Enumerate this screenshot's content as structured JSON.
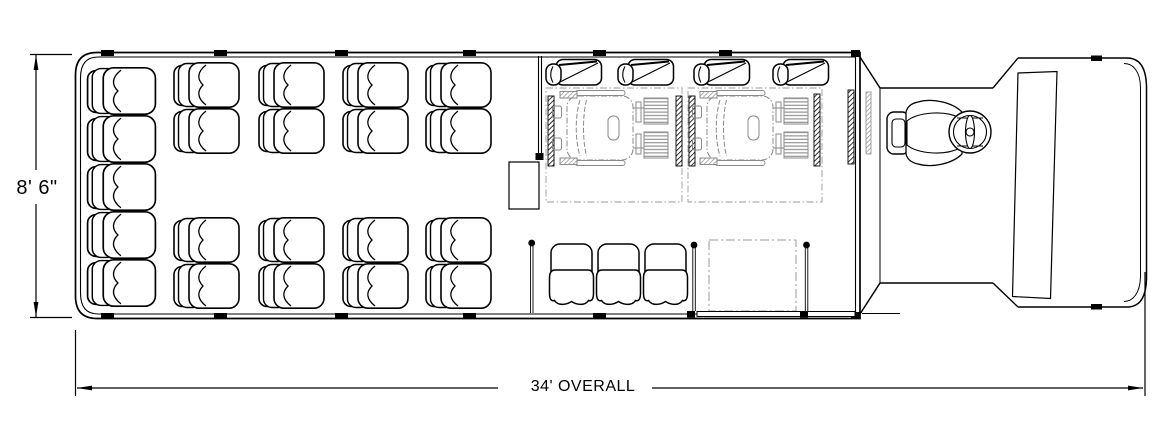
{
  "page": {
    "background": "#ffffff",
    "line_color": "#000000",
    "detail_color": "#878787"
  },
  "dimensions": {
    "height_label": "8' 6\"",
    "length_label": "34' OVERALL"
  },
  "floorplan": {
    "view": "top",
    "rear_bench_seats": 5,
    "forward_double_seat_units": 8,
    "forward_seats_total": 16,
    "flip_up_seats": 4,
    "aft_bench_seats": 3,
    "wheelchair_positions": 2,
    "driver_positions": 1
  }
}
